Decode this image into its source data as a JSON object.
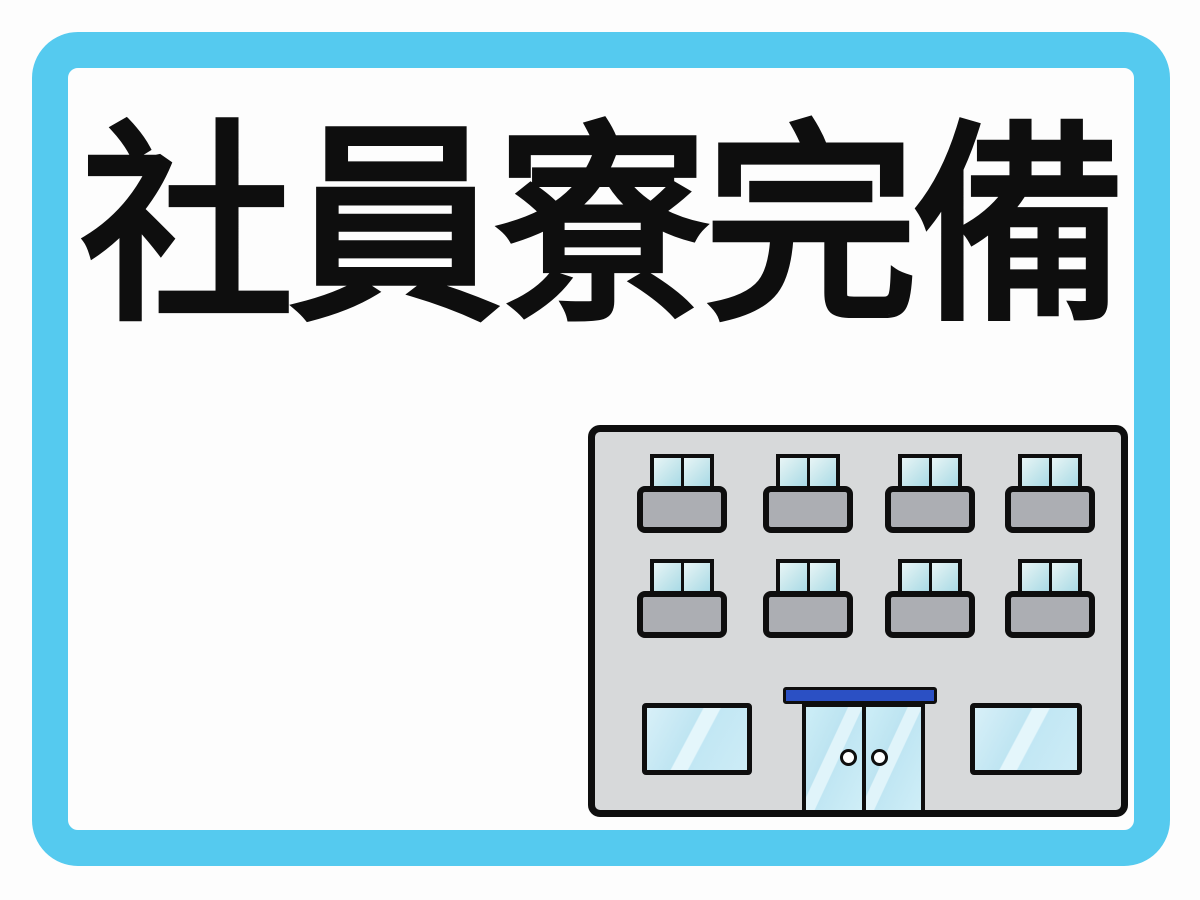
{
  "title": {
    "text": "社員寮完備"
  },
  "colors": {
    "frame": "#55CAEF",
    "ink": "#0E0E0E",
    "face": "#D7D9DA",
    "balcony": "#ACAEB3",
    "glass_hi": "#E8F5F6",
    "awning": "#2B50C4",
    "background": "#FDFDFD"
  },
  "illustration": {
    "label": "dormitory-apartment-building",
    "balcony_rows": 2,
    "balcony_columns": 4,
    "balcony_window_count": 8,
    "ground_floor_window_count": 2,
    "entrance": "double glass doors with blue awning and round handles"
  }
}
